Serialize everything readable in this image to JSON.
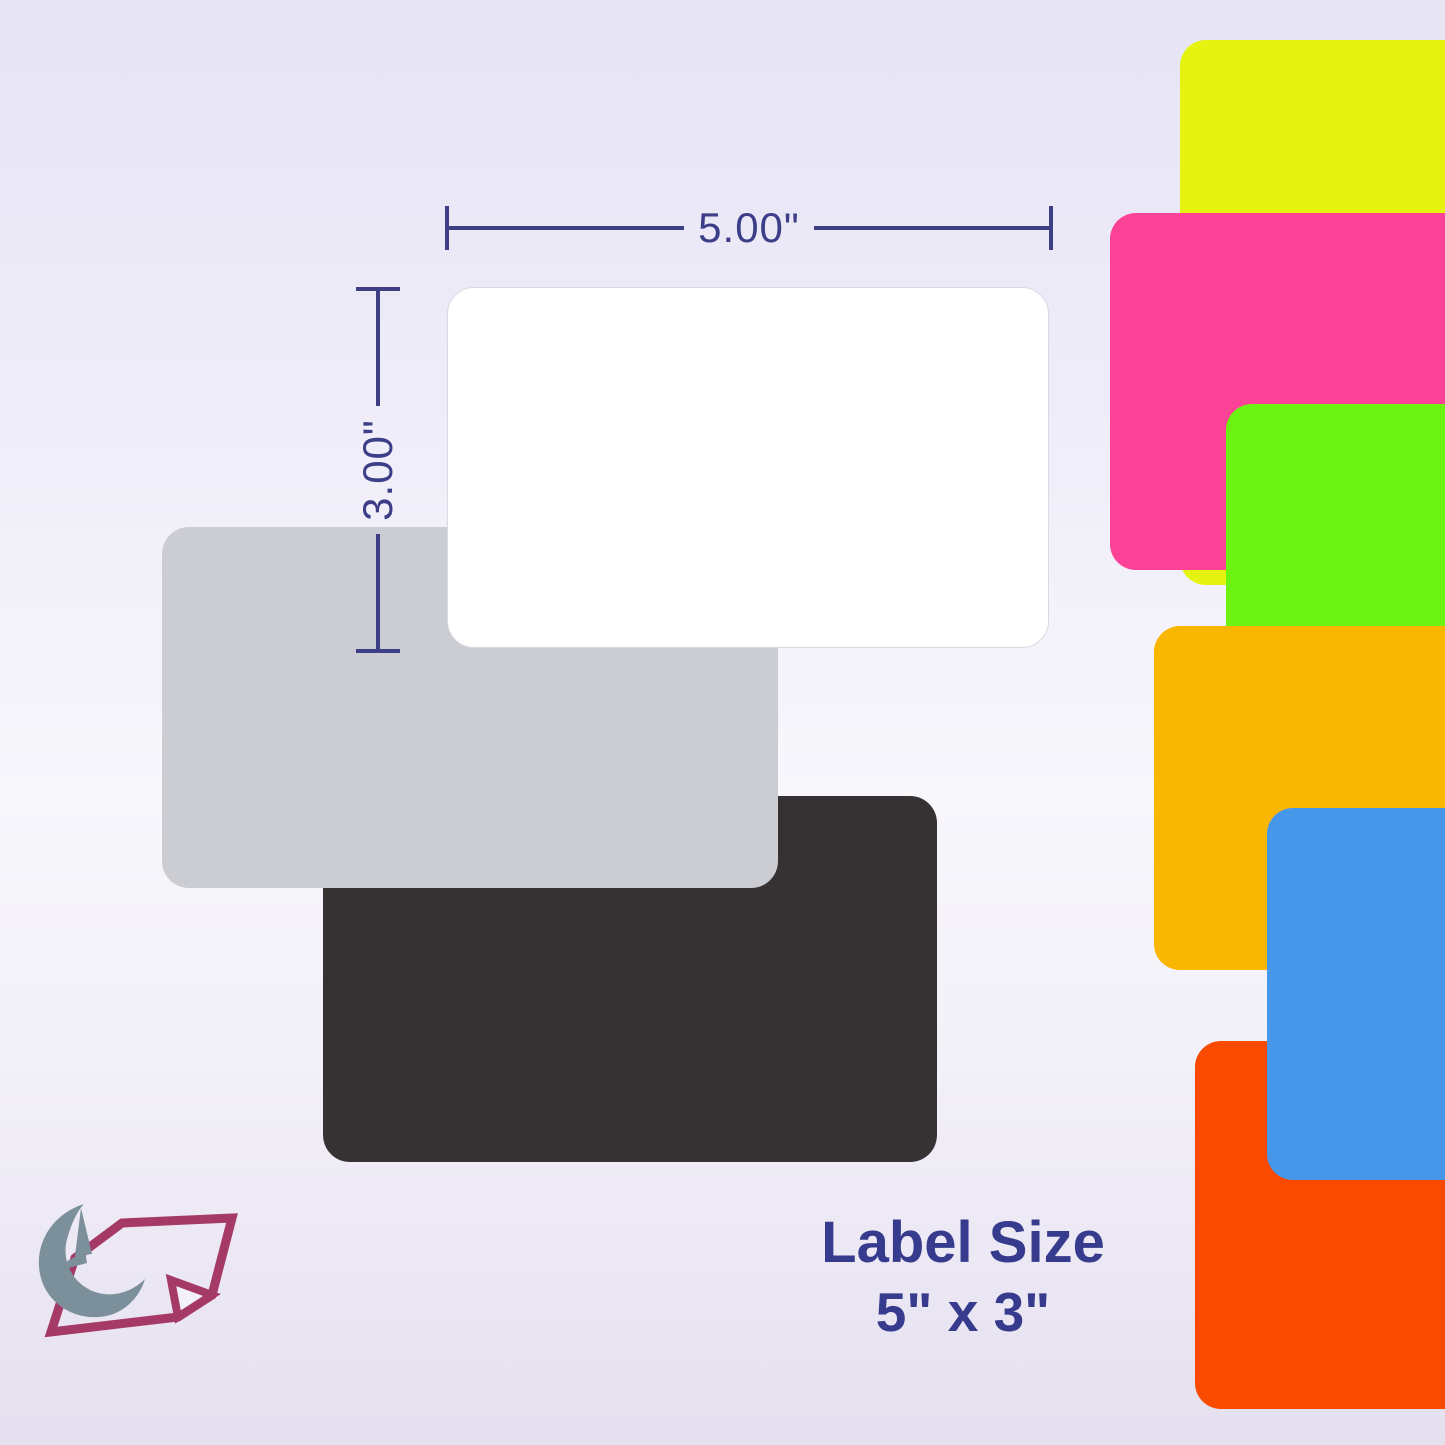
{
  "background": {
    "top_color": "#e8e5f5",
    "middle_color": "#f8f7fc",
    "bottom_color": "#e4e0ef"
  },
  "dimension_annotations": {
    "width_label": "5.00\"",
    "height_label": "3.00\"",
    "line_color": "#3e3e85",
    "text_color": "#3c3e88"
  },
  "label_diagram": {
    "front_label_color": "#ffffff",
    "middle_label_color": "#cccdd2",
    "back_label_color": "#363233"
  },
  "color_swatches": [
    {
      "name": "neon-yellow",
      "color": "#e6f20f"
    },
    {
      "name": "neon-pink",
      "color": "#fb4297"
    },
    {
      "name": "neon-green",
      "color": "#6df312"
    },
    {
      "name": "amber",
      "color": "#f9b602"
    },
    {
      "name": "orange-red",
      "color": "#f94a00"
    },
    {
      "name": "blue",
      "color": "#4697ea"
    }
  ],
  "caption": {
    "line1": "Label Size",
    "line2": "5\" x 3\"",
    "text_color": "#363b8d"
  },
  "logo": {
    "crescent_color": "#7b909b",
    "note_color": "#a63a67",
    "note_fill": "#f3f1f9"
  }
}
